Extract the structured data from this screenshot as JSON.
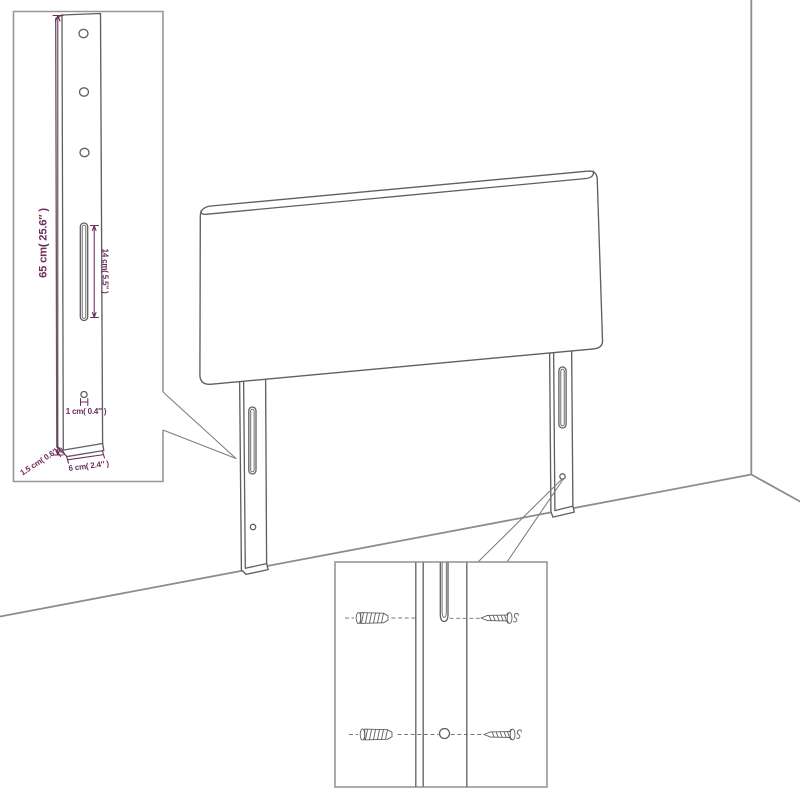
{
  "colors": {
    "background": "#ffffff",
    "artwork_line": "#5f5f5f",
    "wall_line": "#8c8c8c",
    "inset_border": "#979797",
    "dimension": "#6e2c5c"
  },
  "leg_detail_inset": {
    "dim_height": "65 cm( 25.6″ )",
    "dim_slot": "14 cm( 5.5″ )",
    "dim_hole": "1 cm( 0.4″ )",
    "dim_thickness": "1.5 cm( 0.6″ )",
    "dim_width": "6 cm( 2.4″ )"
  },
  "mount_detail_inset": {
    "anchor_part": "wall-anchor",
    "screw_part": "screw"
  }
}
